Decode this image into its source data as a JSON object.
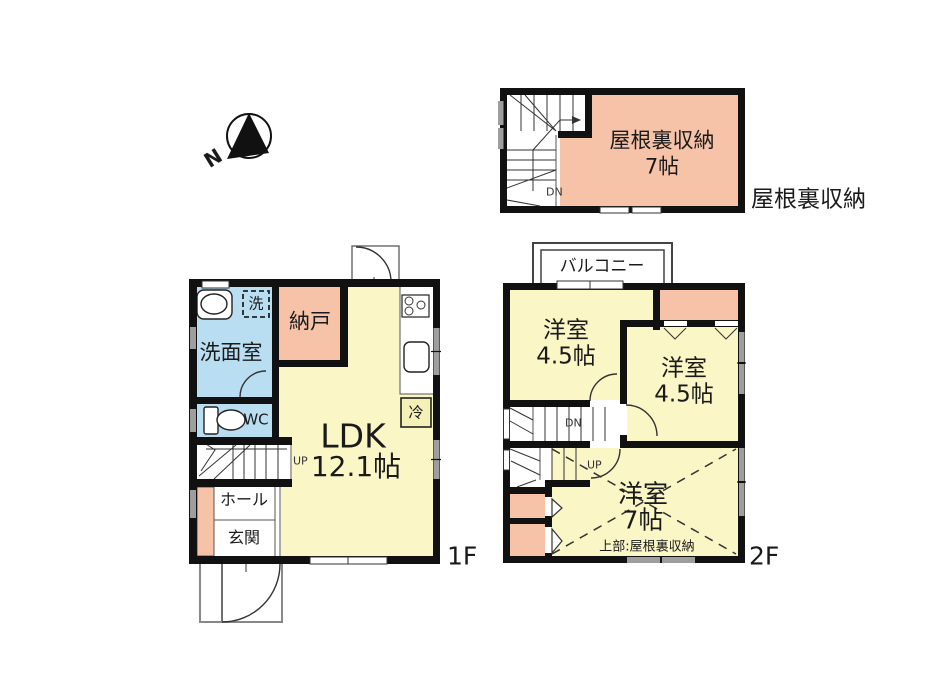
{
  "meta": {
    "attic_outside_label": "屋根裏収納",
    "compass_n": "N",
    "floor1_label": "1F",
    "floor2_label": "2F"
  },
  "attic": {
    "room_name": "屋根裏収納",
    "room_size": "7帖",
    "stairs_down": "DN"
  },
  "floor1": {
    "washroom": "洗面室",
    "laundry": "洗",
    "storeroom": "納戸",
    "wc": "WC",
    "ldk_name": "LDK",
    "ldk_size": "12.1帖",
    "hall": "ホール",
    "entrance": "玄関",
    "fridge": "冷",
    "stairs_up": "UP"
  },
  "floor2": {
    "balcony": "バルコニー",
    "bedroom_a_name": "洋室",
    "bedroom_a_size": "4.5帖",
    "bedroom_b_name": "洋室",
    "bedroom_b_size": "4.5帖",
    "bedroom_c_name": "洋室",
    "bedroom_c_size": "7帖",
    "bedroom_c_note": "上部:屋根裏収納",
    "stairs_down": "DN",
    "stairs_up": "UP"
  },
  "colors": {
    "room_pink": "#f6c3a9",
    "room_yellow": "#faf6c6",
    "room_blue": "#b9def2",
    "wall": "#111111",
    "window_gray": "#9e9e9e"
  }
}
